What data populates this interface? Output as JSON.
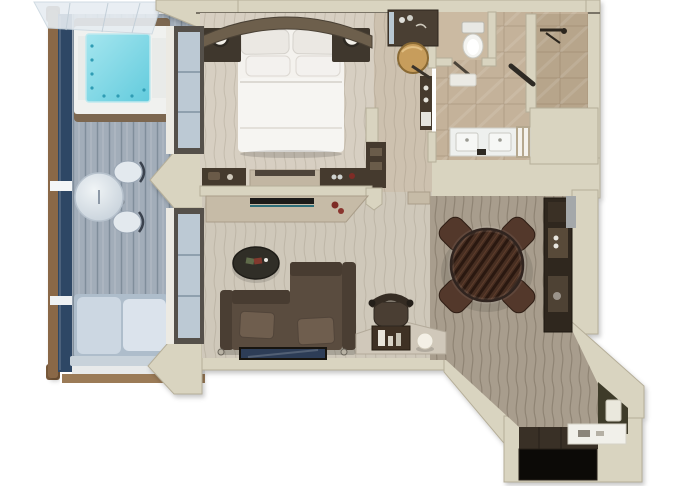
{
  "meta": {
    "scene": "one-bedroom-suite-floor-plan",
    "style": "top-down-3d-render",
    "canvas": {
      "width": 680,
      "height": 486
    }
  },
  "colors": {
    "wall": "#d9d4c0",
    "wall_edge": "#b5ae99",
    "wall_line": "#5a544a",
    "bedroom_carpet": "#d7cfc2",
    "living_carpet": "#cfc8ba",
    "corridor_carpet": "#cdc1af",
    "bath_marble": "#c4b29a",
    "toilet_marble": "#cbbaa2",
    "shower_marble": "#b7a58b",
    "wood_floor": "#a89d8d",
    "deck": "#a2adb9",
    "rail_navy": "#2e4765",
    "rail_wood": "#8a6847",
    "canopy": "#e7edf2",
    "hot_tub_water_light": "#a5e6ef",
    "hot_tub_water": "#62cbdd",
    "tub_frame": "#f0f1ef",
    "tub_wood": "#7c6750",
    "glass_blue": "#bcc9d4",
    "white_trim": "#eceae3",
    "bed_white": "#f4f2ee",
    "pillow_white": "#ebe8e3",
    "headboard_wood": "#6d5f4c",
    "furniture_dark": "#453a2e",
    "nightstand": "#3f372d",
    "console_wood": "#c6bba7",
    "tv_black": "#1c1b19",
    "accent_teal": "#2e6f7a",
    "accent_red": "#7e2c26",
    "sofa": "#5a4c3f",
    "sofa_dark": "#483c31",
    "sofa_arm": "#4a3e33",
    "sofa_pillow": "#6f5e4e",
    "coffee_table": "#302e27",
    "art_navy": "#2d3d57",
    "desk_top": "#d0c8ba",
    "desk_shelf": "#3f3124",
    "globe_lamp": "#f4f0e6",
    "ottoman_gold": "#c79d5c",
    "dining_table": "#432c20",
    "dining_chair": "#53382b",
    "bar_cabinet": "#2f271e",
    "entry_mat": "#393026",
    "entry_door": "#0c0a07",
    "olive_wall": "#3e3b29",
    "porcelain": "#f4f4f1",
    "vanity_white": "#eef0ee",
    "lounger_cushion": "#ccd7e2",
    "lounger_base": "#aebdcb"
  },
  "rooms": [
    {
      "id": "balcony",
      "label": "balcony",
      "furnishings": [
        "glass-canopy",
        "hot-tub",
        "round-table",
        "two-chairs",
        "lounger",
        "navy-railing"
      ]
    },
    {
      "id": "bedroom",
      "label": "bedroom",
      "furnishings": [
        "king-bed",
        "curved-headboard-wall",
        "nightstand-left",
        "nightstand-right",
        "bedside-lamps",
        "dresser-row"
      ]
    },
    {
      "id": "dressing-corridor",
      "label": "dressing-corridor",
      "furnishings": [
        "wardrobe",
        "gold-ottoman",
        "cabinet-strip"
      ]
    },
    {
      "id": "bathroom",
      "label": "bathroom",
      "furnishings": [
        "toilet",
        "shower",
        "glass-shower-door",
        "double-vanity"
      ]
    },
    {
      "id": "living-room",
      "label": "living-room",
      "furnishings": [
        "media-console",
        "tv",
        "sofa",
        "coffee-table",
        "wall-art",
        "desk",
        "desk-chair",
        "globe-lamp"
      ]
    },
    {
      "id": "dining-area",
      "label": "dining-area",
      "furnishings": [
        "round-dining-table",
        "four-chairs",
        "bar-cabinet"
      ]
    },
    {
      "id": "entry",
      "label": "entry-hall",
      "furnishings": [
        "entry-door",
        "door-mat",
        "console-shelf",
        "door-card-panel"
      ]
    }
  ]
}
